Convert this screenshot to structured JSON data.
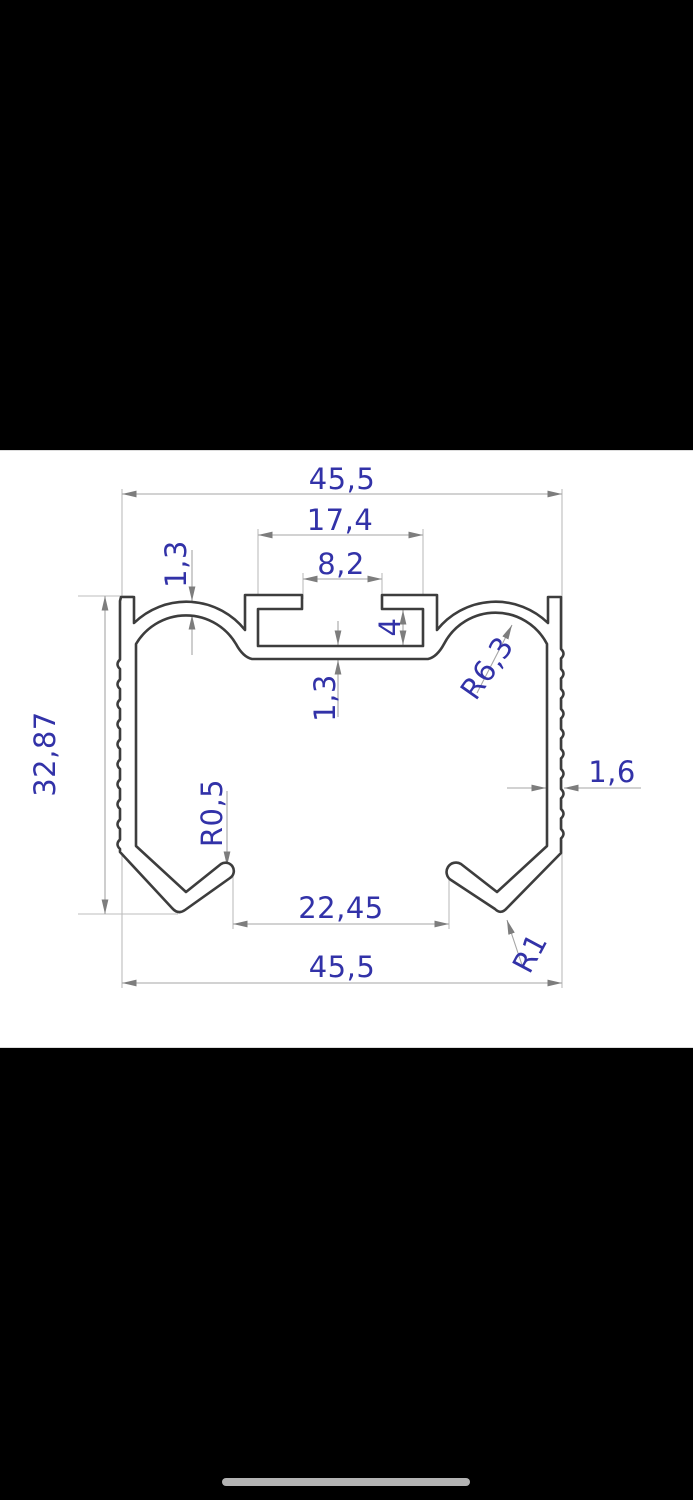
{
  "screen": {
    "background": "#000000",
    "canvas_background": "#ffffff"
  },
  "drawing": {
    "type": "technical-cross-section-profile",
    "colors": {
      "profile_line": "#3d3d3d",
      "dimension_line": "#a6a6a6",
      "extension_line": "#bdbdbd",
      "arrow": "#7d7d7d",
      "label_text": "#3232a8",
      "home_indicator": "#b3b3b3"
    },
    "labels": {
      "overall_width_top": "45,5",
      "slot_cavity_width": "17,4",
      "slot_opening_width": "8,2",
      "dome_wall_thickness": "1,3",
      "slot_depth": "4",
      "slot_floor_thickness": "1,3",
      "dome_radius": "R6,3",
      "overall_height": "32,87",
      "side_wall_thickness": "1,6",
      "hook_tip_radius": "R0,5",
      "bottom_opening_width": "22,45",
      "hook_bend_radius": "R1",
      "overall_width_bottom": "45,5"
    }
  }
}
